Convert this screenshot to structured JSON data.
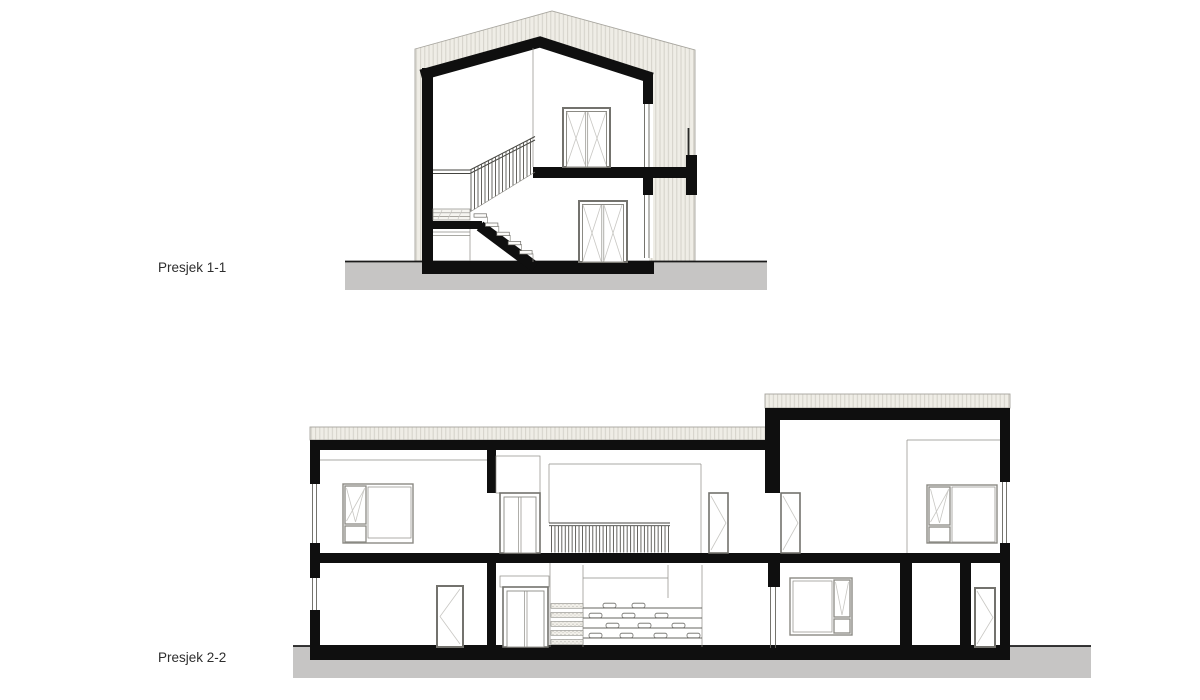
{
  "drawing": {
    "label_section_1": "Presjek 1-1",
    "label_section_2": "Presjek 2-2"
  },
  "colors": {
    "paper": "#ffffff",
    "ink": "#0f0f0f",
    "siding_fill": "#efede6",
    "siding_line": "#d4d1c9",
    "ground_fill": "#c6c5c4",
    "ground_line": "#1b1b1b",
    "frame_gray": "#8b8a84",
    "line_medium": "#66655f",
    "line_light": "#c8c7c3",
    "label": "#2e2e2e"
  }
}
